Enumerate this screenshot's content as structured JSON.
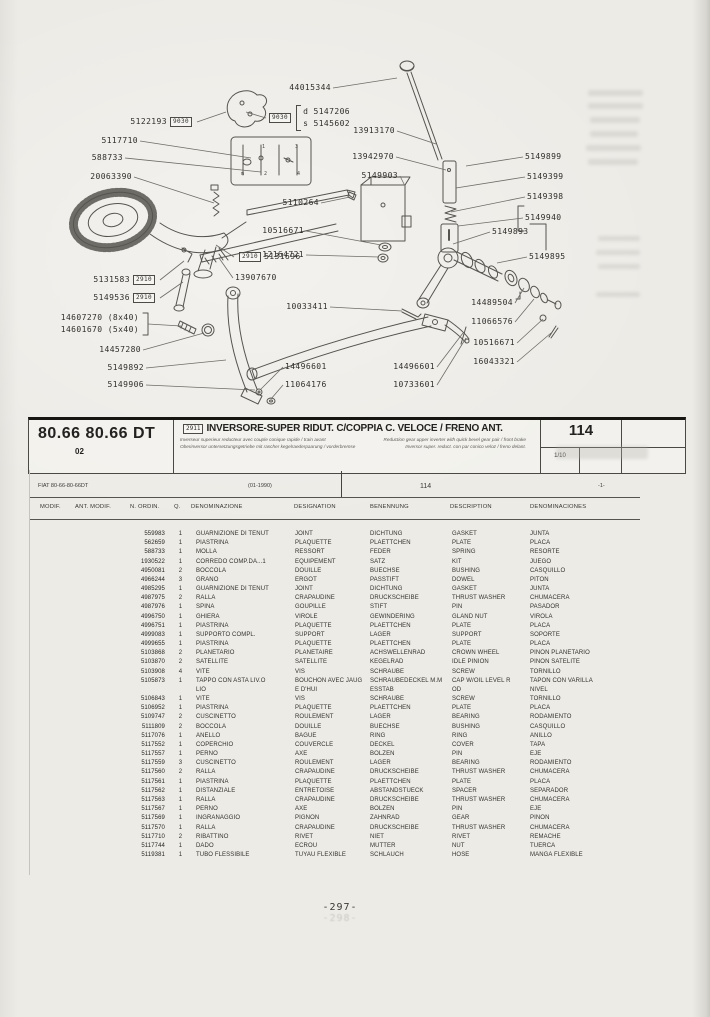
{
  "band": {
    "model": "80.66 80.66 DT",
    "code": "02",
    "ref": "2911",
    "title": "INVERSORE-SUPER RIDUT. C/COPPIA C. VELOCE / FRENO ANT.",
    "sub_fr": "Inverseur superieur reducteur avec couple conique rapide / train avant",
    "sub_en": "Reduction gear upper inverter with quick bevel gear pair / front brake",
    "sub_de": "Oberinversor untersetzungsgetriebe mit rascher kegelraederpaarung / vorderbremse",
    "sub_es": "Inversor super. reduct. con par conico veloz / freno delant.",
    "page": "114",
    "sheet": "1/10"
  },
  "subheader": {
    "model": "FIAT 80-66-80-66DT",
    "date": "(01-1990)",
    "page": "114",
    "index": "-1-"
  },
  "footer": {
    "page": "-297-",
    "ghost": "-298-"
  },
  "diagram": {
    "ds": {
      "box": "9030",
      "d_key": "d",
      "d_val": "5147206",
      "s_key": "s",
      "s_val": "5145602"
    },
    "extra_leaders": [
      [
        266,
        118,
        246,
        112
      ]
    ],
    "labels": [
      {
        "text": "44015344",
        "side": "w",
        "x": 333,
        "y": 88,
        "tx": 397,
        "ty": 78
      },
      {
        "text": "5122193",
        "side": "w",
        "x": 197,
        "y": 122,
        "box": "9030",
        "tx": 226,
        "ty": 112
      },
      {
        "text": "5117710",
        "side": "w",
        "x": 140,
        "y": 141,
        "tx": 251,
        "ty": 158
      },
      {
        "text": "588733",
        "side": "w",
        "x": 125,
        "y": 158,
        "tx": 261,
        "ty": 172
      },
      {
        "text": "20063390",
        "side": "w",
        "x": 134,
        "y": 177,
        "tx": 214,
        "ty": 203
      },
      {
        "text": "13913170",
        "side": "w",
        "x": 397,
        "y": 131,
        "tx": 436,
        "ty": 144
      },
      {
        "text": "13942970",
        "side": "w",
        "x": 396,
        "y": 157,
        "tx": 446,
        "ty": 170
      },
      {
        "text": "5149903",
        "side": "w",
        "x": 400,
        "y": 176,
        "tx": 405,
        "ty": 186
      },
      {
        "text": "5110264",
        "side": "w",
        "x": 321,
        "y": 203,
        "tx": 350,
        "ty": 197
      },
      {
        "text": "10516671",
        "side": "w",
        "x": 306,
        "y": 231,
        "tx": 381,
        "ty": 245
      },
      {
        "text": "12164721",
        "side": "w",
        "x": 306,
        "y": 255,
        "tx": 379,
        "ty": 257
      },
      {
        "text": "10033411",
        "side": "w",
        "x": 330,
        "y": 307,
        "tx": 402,
        "ty": 311
      },
      {
        "text": "5131583",
        "side": "w",
        "x": 160,
        "y": 280,
        "box": "2910",
        "tx": 184,
        "ty": 261
      },
      {
        "text": "5149536",
        "side": "w",
        "x": 160,
        "y": 298,
        "box": "2910",
        "tx": 183,
        "ty": 282
      },
      {
        "text": "14607270 (8x40)",
        "side": "w",
        "x": 141,
        "y": 318,
        "lx": 148,
        "ly": 324,
        "tx": 181,
        "ty": 326
      },
      {
        "text": "14601670 (5x40)",
        "side": "w",
        "x": 141,
        "y": 330
      },
      {
        "text": "14457280",
        "side": "w",
        "x": 143,
        "y": 350,
        "tx": 204,
        "ty": 333
      },
      {
        "text": "5149892",
        "side": "w",
        "x": 146,
        "y": 368,
        "tx": 226,
        "ty": 360
      },
      {
        "text": "5149906",
        "side": "w",
        "x": 146,
        "y": 385,
        "tx": 255,
        "ty": 390
      },
      {
        "text": "14496601",
        "side": "e",
        "x": 283,
        "y": 367,
        "tx": 261,
        "ty": 389
      },
      {
        "text": "11064176",
        "side": "e",
        "x": 283,
        "y": 385,
        "tx": 271,
        "ty": 399
      },
      {
        "text": "14496601",
        "side": "w",
        "x": 437,
        "y": 367,
        "tx": 463,
        "ty": 333
      },
      {
        "text": "10733601",
        "side": "w",
        "x": 437,
        "y": 385,
        "tx": 466,
        "ty": 338
      },
      {
        "text": "14489504",
        "side": "w",
        "x": 515,
        "y": 303,
        "tx": 524,
        "ty": 288
      },
      {
        "text": "11066576",
        "side": "w",
        "x": 515,
        "y": 322,
        "tx": 534,
        "ty": 299
      },
      {
        "text": "10516671",
        "side": "w",
        "x": 517,
        "y": 343,
        "tx": 543,
        "ty": 319
      },
      {
        "text": "16043321",
        "side": "w",
        "x": 517,
        "y": 362,
        "tx": 551,
        "ty": 333
      },
      {
        "text": "5131696",
        "side": "e",
        "x": 234,
        "y": 257,
        "box": "2910",
        "boxPos": "before",
        "tx": 216,
        "ty": 245
      },
      {
        "text": "13907670",
        "side": "e",
        "x": 233,
        "y": 278,
        "tx": 219,
        "ty": 258
      },
      {
        "text": "5149899",
        "side": "e",
        "x": 523,
        "y": 157,
        "tx": 466,
        "ty": 166
      },
      {
        "text": "5149399",
        "side": "e",
        "x": 525,
        "y": 177,
        "tx": 456,
        "ty": 188
      },
      {
        "text": "5149398",
        "side": "e",
        "x": 525,
        "y": 197,
        "tx": 451,
        "ty": 212
      },
      {
        "text": "5149940",
        "side": "e",
        "x": 523,
        "y": 218,
        "tx": 458,
        "ty": 226
      },
      {
        "text": "5149893",
        "side": "e",
        "x": 490,
        "y": 232,
        "tx": 453,
        "ty": 244
      },
      {
        "text": "5149895",
        "side": "e",
        "x": 527,
        "y": 257,
        "tx": 497,
        "ty": 263
      },
      {
        "text": "m",
        "side": "e",
        "x": 239,
        "y": 174,
        "small": true
      },
      {
        "text": "1",
        "side": "e",
        "x": 260,
        "y": 147,
        "small": true
      },
      {
        "text": "2",
        "side": "e",
        "x": 262,
        "y": 174,
        "small": true
      },
      {
        "text": "3",
        "side": "e",
        "x": 293,
        "y": 147,
        "small": true
      },
      {
        "text": "4",
        "side": "e",
        "x": 295,
        "y": 174,
        "small": true
      }
    ]
  },
  "table": {
    "headers": [
      "MODIF.",
      "ANT. MODIF.",
      "N. ORDIN.",
      "Q.",
      "DENOMINAZIONE",
      "DESIGNATION",
      "BENENNUNG",
      "DESCRIPTION",
      "DENOMINACIONES"
    ],
    "rows": [
      [
        "559983",
        "1",
        "GUARNIZIONE DI TENUT",
        "JOINT",
        "DICHTUNG",
        "GASKET",
        "JUNTA"
      ],
      [
        "562659",
        "1",
        "PIASTRINA",
        "PLAQUETTE",
        "PLAETTCHEN",
        "PLATE",
        "PLACA"
      ],
      [
        "588733",
        "1",
        "MOLLA",
        "RESSORT",
        "FEDER",
        "SPRING",
        "RESORTE"
      ],
      [
        "1930522",
        "1",
        "CORREDO COMP.DA...1",
        "EQUIPEMENT",
        "SATZ",
        "KIT",
        "JUEGO"
      ],
      [
        "4950081",
        "2",
        "BOCCOLA",
        "DOUILLE",
        "BUECHSE",
        "BUSHING",
        "CASQUILLO"
      ],
      [
        "4966244",
        "3",
        "GRANO",
        "ERGOT",
        "PASSTIFT",
        "DOWEL",
        "PITON"
      ],
      [
        "4985295",
        "1",
        "GUARNIZIONE DI TENUT",
        "JOINT",
        "DICHTUNG",
        "GASKET",
        "JUNTA"
      ],
      [
        "4987975",
        "2",
        "RALLA",
        "CRAPAUDINE",
        "DRUCKSCHEIBE",
        "THRUST WASHER",
        "CHUMACERA"
      ],
      [
        "4987976",
        "1",
        "SPINA",
        "GOUPILLE",
        "STIFT",
        "PIN",
        "PASADOR"
      ],
      [
        "4996750",
        "1",
        "GHIERA",
        "VIROLE",
        "GEWINDERING",
        "GLAND NUT",
        "VIROLA"
      ],
      [
        "4996751",
        "1",
        "PIASTRINA",
        "PLAQUETTE",
        "PLAETTCHEN",
        "PLATE",
        "PLACA"
      ],
      [
        "4999083",
        "1",
        "SUPPORTO COMPL.",
        "SUPPORT",
        "LAGER",
        "SUPPORT",
        "SOPORTE"
      ],
      [
        "4999655",
        "1",
        "PIASTRINA",
        "PLAQUETTE",
        "PLAETTCHEN",
        "PLATE",
        "PLACA"
      ],
      [
        "5103868",
        "2",
        "PLANETARIO",
        "PLANETAIRE",
        "ACHSWELLENRAD",
        "CROWN WHEEL",
        "PINON PLANETARIO"
      ],
      [
        "5103870",
        "2",
        "SATELLITE",
        "SATELLITE",
        "KEGELRAD",
        "IDLE PINION",
        "PINON SATELITE"
      ],
      [
        "5103908",
        "4",
        "VITE",
        "VIS",
        "SCHRAUBE",
        "SCREW",
        "TORNILLO"
      ],
      [
        "5105873",
        "1",
        "TAPPO CON ASTA LIV.O\nLIO",
        "BOUCHON AVEC JAUG\nE D'HUI",
        "SCHRAUBEDECKEL M.M\nESSTAB",
        "CAP W/OIL LEVEL R\nOD",
        "TAPON CON VARILLA\nNIVEL"
      ],
      [
        "5106843",
        "1",
        "VITE",
        "VIS",
        "SCHRAUBE",
        "SCREW",
        "TORNILLO"
      ],
      [
        "5106952",
        "1",
        "PIASTRINA",
        "PLAQUETTE",
        "PLAETTCHEN",
        "PLATE",
        "PLACA"
      ],
      [
        "5109747",
        "2",
        "CUSCINETTO",
        "ROULEMENT",
        "LAGER",
        "BEARING",
        "RODAMIENTO"
      ],
      [
        "5111809",
        "2",
        "BOCCOLA",
        "DOUILLE",
        "BUECHSE",
        "BUSHING",
        "CASQUILLO"
      ],
      [
        "5117076",
        "1",
        "ANELLO",
        "BAGUE",
        "RING",
        "RING",
        "ANILLO"
      ],
      [
        "5117552",
        "1",
        "COPERCHIO",
        "COUVERCLE",
        "DECKEL",
        "COVER",
        "TAPA"
      ],
      [
        "5117557",
        "1",
        "PERNO",
        "AXE",
        "BOLZEN",
        "PIN",
        "EJE"
      ],
      [
        "5117559",
        "3",
        "CUSCINETTO",
        "ROULEMENT",
        "LAGER",
        "BEARING",
        "RODAMIENTO"
      ],
      [
        "5117560",
        "2",
        "RALLA",
        "CRAPAUDINE",
        "DRUCKSCHEIBE",
        "THRUST WASHER",
        "CHUMACERA"
      ],
      [
        "5117561",
        "1",
        "PIASTRINA",
        "PLAQUETTE",
        "PLAETTCHEN",
        "PLATE",
        "PLACA"
      ],
      [
        "5117562",
        "1",
        "DISTANZIALE",
        "ENTRETOISE",
        "ABSTANDSTUECK",
        "SPACER",
        "SEPARADOR"
      ],
      [
        "5117563",
        "1",
        "RALLA",
        "CRAPAUDINE",
        "DRUCKSCHEIBE",
        "THRUST WASHER",
        "CHUMACERA"
      ],
      [
        "5117567",
        "1",
        "PERNO",
        "AXE",
        "BOLZEN",
        "PIN",
        "EJE"
      ],
      [
        "5117569",
        "1",
        "INGRANAGGIO",
        "PIGNON",
        "ZAHNRAD",
        "GEAR",
        "PINON"
      ],
      [
        "5117570",
        "1",
        "RALLA",
        "CRAPAUDINE",
        "DRUCKSCHEIBE",
        "THRUST WASHER",
        "CHUMACERA"
      ],
      [
        "5117710",
        "2",
        "RIBATTINO",
        "RIVET",
        "NIET",
        "RIVET",
        "REMACHE"
      ],
      [
        "5117744",
        "1",
        "DADO",
        "ECROU",
        "MUTTER",
        "NUT",
        "TUERCA"
      ],
      [
        "5119381",
        "1",
        "TUBO FLESSIBILE",
        "TUYAU FLEXIBLE",
        "SCHLAUCH",
        "HOSE",
        "MANGA FLEXIBLE"
      ]
    ]
  }
}
